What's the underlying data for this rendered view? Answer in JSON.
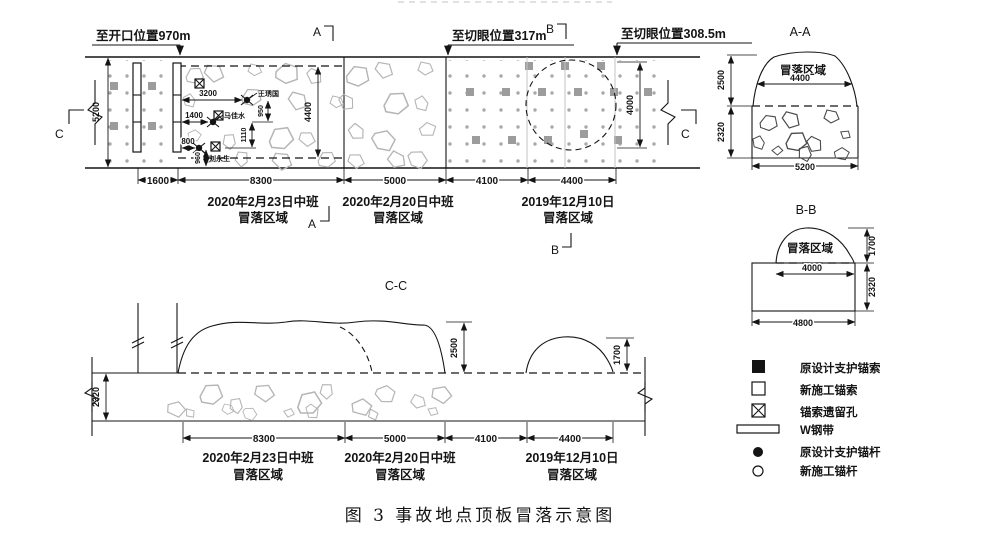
{
  "page": {
    "caption": "图 3 事故地点顶板冒落示意图"
  },
  "top_labels": {
    "to_opening": "至开口位置970m",
    "to_cut_mid": "至切眼位置317m",
    "to_cut_right": "至切眼位置308.5m"
  },
  "marks": {
    "a": "A",
    "b": "B",
    "c": "C"
  },
  "titles": {
    "aa": "A-A",
    "bb": "B-B",
    "cc": "C-C"
  },
  "labels": {
    "collapse_area": "冒落区域"
  },
  "zones": {
    "z1": {
      "line1": "2020年2月23日中班",
      "line2": "冒落区域"
    },
    "z2": {
      "line1": "2020年2月20日中班",
      "line2": "冒落区域"
    },
    "z3": {
      "line1": "2019年12月10日",
      "line2": "冒落区域"
    }
  },
  "victims": [
    "王琇国",
    "马佳水",
    "刘永生"
  ],
  "dims": {
    "plan": {
      "seg1": "1600",
      "seg2": "8300",
      "seg3": "5000",
      "seg4": "4100",
      "seg5": "4400",
      "road_width": "5200",
      "fall_width": "4400",
      "circle": "4000",
      "a1": "3200",
      "a2": "1400",
      "a3": "800",
      "v1": "950",
      "v2": "1110",
      "v3": "960"
    },
    "aa": {
      "upper": "2500",
      "lower": "2320",
      "inner": "4400",
      "outer": "5200"
    },
    "bb": {
      "upper": "1700",
      "lower": "2320",
      "inner": "4000",
      "outer": "4800"
    },
    "cc": {
      "left": "2320",
      "mound": "2500",
      "dome": "1700",
      "seg2": "8300",
      "seg3": "5000",
      "seg4": "4100",
      "seg5": "4400"
    }
  },
  "legend": {
    "items": [
      {
        "symbol": "filled-square",
        "label": "原设计支护锚索"
      },
      {
        "symbol": "open-square",
        "label": "新施工锚索"
      },
      {
        "symbol": "crossed-square",
        "label": "锚索遗留孔"
      },
      {
        "symbol": "steel-band",
        "label": "W钢带"
      },
      {
        "symbol": "filled-circle",
        "label": "原设计支护锚杆"
      },
      {
        "symbol": "open-circle",
        "label": "新施工锚杆"
      }
    ]
  }
}
